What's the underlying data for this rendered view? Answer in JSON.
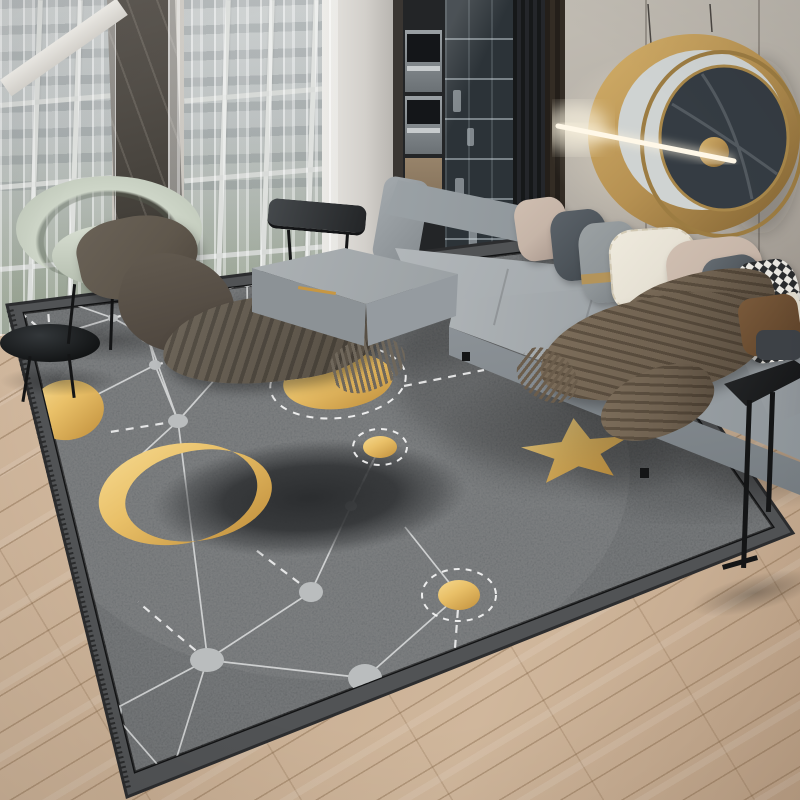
{
  "scene": {
    "alt": "Modern living room product photo: light gray L-shaped sectional sofa on a dark gray celestial constellation area rug with gold moons, sun, dots and a gold star; sheer-curtained floor-to-ceiling windows on the left, built-in kitchen cabinets in the center, and a round gold wall sculpture with an LED light bar on the right wall; light oak plank floor",
    "room": "living room",
    "no_visible_text": true
  },
  "palette": {
    "rug_field": "#5c5f61",
    "rug_band": "#515355",
    "rug_edge": "#121314",
    "rug_node": "#babdbe",
    "rug_web": "#eceded",
    "gold": "#e9c068",
    "gold_deep": "#c79743",
    "eclipse_dark": "#3b3e40",
    "wood": "#c8ae93",
    "wall": "#b3ada4",
    "marble": "#46423c",
    "glass": "#93a09e",
    "curtain": "#f2f2f0",
    "sofa": "#a8aeb2",
    "sofa_mid": "#959ba0",
    "sofa_dark": "#82898e",
    "pillow_taupe": "#c6b5a8",
    "pillow_dark": "#4d545a",
    "pillow_cream": "#e6e1d4",
    "pillow_gray": "#8f9598",
    "throw": "#6f6150",
    "throw_dark": "#574b3d",
    "chair": "#ced6c8",
    "blanket": "#5f574c",
    "art_gold": "#b69152",
    "art_marble": "#353c43",
    "led": "#fff8e8",
    "wood_chair": "#7a5a3b"
  },
  "objects": {
    "rug": {
      "label": "celestial constellation area rug",
      "base_color": "#5c5f61",
      "border": "dark band with thin black inner line",
      "motifs": [
        "large gold sun disc with dashed halo",
        "gold crescent moon eclipsing a dark disc",
        "small gold planet dots with dashed rings (2)",
        "gold five-pointed star",
        "thin gold crescent arc",
        "gray constellation nodes (~20)",
        "white solid and dashed connecting lines"
      ]
    },
    "sofa": {
      "label": "light gray L-shaped sectional sofa",
      "color": "#a8aeb2",
      "pillows": [
        "taupe",
        "dark gray",
        "gray with gold band",
        "cream fringed",
        "taupe",
        "dark gray",
        "black-white houndstooth",
        "cream"
      ],
      "throw": "brown fringed throw blanket"
    },
    "accent_chair": {
      "label": "sage green barrel armchair with draped dark blanket",
      "color": "#ced6c8"
    },
    "wall_art": {
      "label": "round gold wall sculpture with dark marble disc and LED light bar"
    },
    "coffee_table": {
      "label": "low black rectangular table"
    },
    "side_table_left": {
      "label": "black oval side table"
    },
    "side_table_right": {
      "label": "black C-shaped side table"
    },
    "windows": {
      "label": "floor-to-ceiling windows with sheer white curtains and dark marble column"
    },
    "kitchen": {
      "label": "built-in ovens and glass display cabinet niche"
    },
    "floor": {
      "label": "light oak plank flooring",
      "color": "#c8ae93"
    }
  }
}
